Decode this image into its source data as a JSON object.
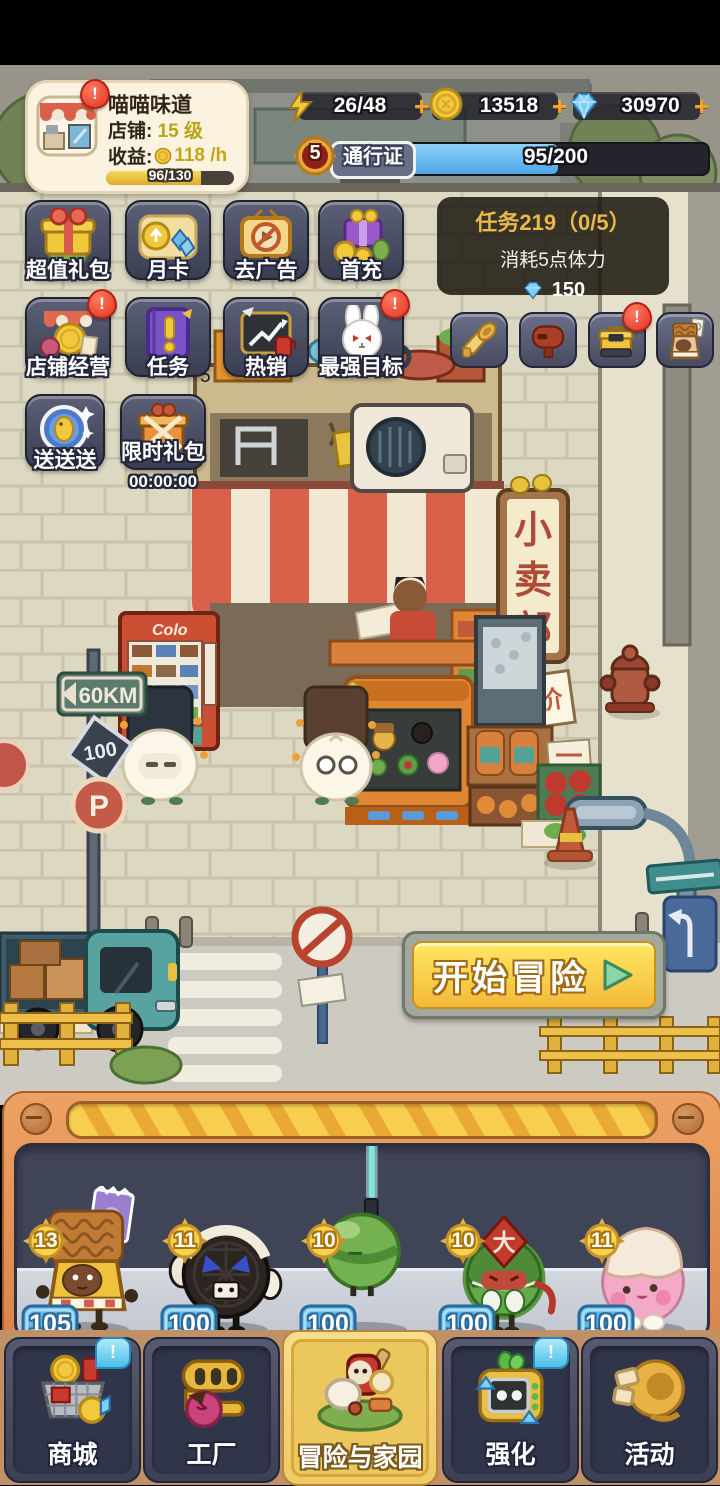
{
  "ui": {
    "alert": "!",
    "plus": "+"
  },
  "header": {
    "shop_card": {
      "name": "喵喵味道",
      "level_label": "店铺:",
      "level_value": "15 级",
      "income_label": "收益:",
      "income_value": "118 /h",
      "xp_progress": "96/130"
    },
    "resources": {
      "energy": "26/48",
      "coins": "13518",
      "diamonds": "30970"
    },
    "battle_pass": {
      "level": "5",
      "label": "通行证",
      "progress": "95/200"
    }
  },
  "task_panel": {
    "title": "任务219（0/5）",
    "description": "消耗5点体力",
    "reward": "150"
  },
  "menu": {
    "row1": [
      {
        "label": "超值礼包"
      },
      {
        "label": "月卡"
      },
      {
        "label": "去广告"
      },
      {
        "label": "首充"
      }
    ],
    "row2": [
      {
        "label": "店铺经营",
        "badge": "!"
      },
      {
        "label": "任务"
      },
      {
        "label": "热销"
      },
      {
        "label": "最强目标",
        "badge": "!"
      }
    ],
    "row3": [
      {
        "label": "送送送"
      },
      {
        "label": "限时礼包",
        "timer": "00:00:00"
      }
    ]
  },
  "scene": {
    "stray_number": "5",
    "shop_sign": "小卖部",
    "sale_tag": "减价",
    "speed_sign": "60KM",
    "distance_sign": "100",
    "parking_sign": "P",
    "vending_brand": "Colo",
    "gum_hat": "大"
  },
  "adventure": {
    "label": "开始冒险"
  },
  "roster": {
    "members": [
      {
        "name": "干脆面",
        "level": "13",
        "power": "105"
      },
      {
        "name": "黑白饼干",
        "level": "11",
        "power": "100"
      },
      {
        "name": "棒棒糖",
        "level": "10",
        "power": "100"
      },
      {
        "name": "卷卷口香糖",
        "level": "10",
        "power": "100"
      },
      {
        "name": "棉花糖糖",
        "level": "11",
        "power": "100"
      }
    ]
  },
  "bottom_nav": {
    "tabs": [
      {
        "label": "商城",
        "notify": "!"
      },
      {
        "label": "工厂"
      },
      {
        "label": "冒险与家园",
        "active": true
      },
      {
        "label": "强化",
        "notify": "!"
      },
      {
        "label": "活动"
      }
    ]
  }
}
